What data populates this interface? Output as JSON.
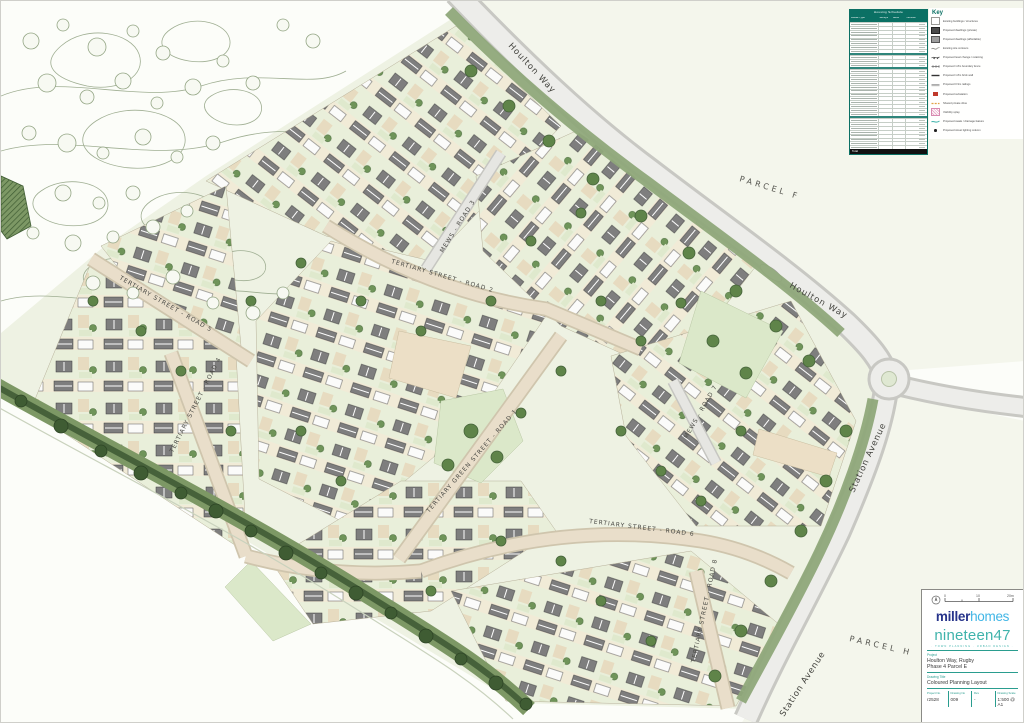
{
  "plan": {
    "street_labels": [
      {
        "text": "Houlton Way"
      },
      {
        "text": "Houlton Way"
      },
      {
        "text": "Station Avenue"
      },
      {
        "text": "Station Avenue"
      },
      {
        "text": "PARCEL F"
      },
      {
        "text": "PARCEL H"
      },
      {
        "text": "TERTIARY STREET - ROAD 2"
      },
      {
        "text": "MEWS - ROAD 3"
      },
      {
        "text": "TERTIARY STREET - ROAD 4"
      },
      {
        "text": "TERTIARY STREET - ROAD 5"
      },
      {
        "text": "TERTIARY GREEN STREET - ROAD 1"
      },
      {
        "text": "TERTIARY STREET - ROAD 6"
      },
      {
        "text": "MEWS - ROAD 7"
      },
      {
        "text": "TERTIARY STREET - ROAD 8"
      }
    ]
  },
  "schedule_table": {
    "title": "Housing Schedule",
    "columns": [
      "House Type",
      "Storeys",
      "Beds",
      "Number"
    ],
    "sections": [
      8,
      3,
      12,
      8
    ],
    "total_label": "Total",
    "total_value": ""
  },
  "key": {
    "title": "Key",
    "items": [
      {
        "icon": "existing-building",
        "label": "Existing buildings / structures"
      },
      {
        "icon": "private-dwelling",
        "label": "Proposed dwellings (private)"
      },
      {
        "icon": "affordable-dwelling",
        "label": "Proposed dwellings (affordable)"
      },
      {
        "icon": "existing-contour",
        "label": "Existing site contours"
      },
      {
        "icon": "level-change",
        "label": "Proposed level change / retaining"
      },
      {
        "icon": "fence",
        "label": "Proposed 1.8m boundary fence"
      },
      {
        "icon": "wall",
        "label": "Proposed 1.8m brick wall"
      },
      {
        "icon": "railing",
        "label": "Proposed 0.9m railings"
      },
      {
        "icon": "substation",
        "label": "Proposed substation"
      },
      {
        "icon": "shared-drive",
        "label": "Shared private drive"
      },
      {
        "icon": "visibility-splay",
        "label": "Visibility splay"
      },
      {
        "icon": "swale",
        "label": "Proposed swale / drainage feature"
      },
      {
        "icon": "street-light",
        "label": "Proposed street lighting column"
      }
    ]
  },
  "title_block": {
    "scale": {
      "zero": "0",
      "mid": "10",
      "end": "20m"
    },
    "miller": "miller",
    "homes": "homes",
    "nineteen47": "nineteen47",
    "tagline": "· TOWN PLANNING · URBAN DESIGN ·",
    "project_label": "Project",
    "project_line1": "Houlton Way, Rugby",
    "project_line2": "Phase 4 Parcel E",
    "drawing_title_label": "Drawing Title",
    "drawing_title": "Coloured Planning Layout",
    "fields": [
      {
        "label": "Project No.",
        "value": "r2528"
      },
      {
        "label": "Drawing No",
        "value": "009"
      },
      {
        "label": "Rev",
        "value": "-"
      },
      {
        "label": "Drawing Scale",
        "value": "1:500 @ A1"
      }
    ]
  },
  "colors": {
    "teal": "#0b7064",
    "brand_navy": "#27348b",
    "brand_blue": "#41b6e6",
    "n47_teal": "#3fb3ab",
    "road_fill": "#ededea",
    "verge_green": "#8fa87a",
    "hedge_green": "#46613a",
    "garden_green": "#e9efda",
    "garden_cream": "#f1ebd7",
    "roof_gray": "#7e7e7e"
  }
}
